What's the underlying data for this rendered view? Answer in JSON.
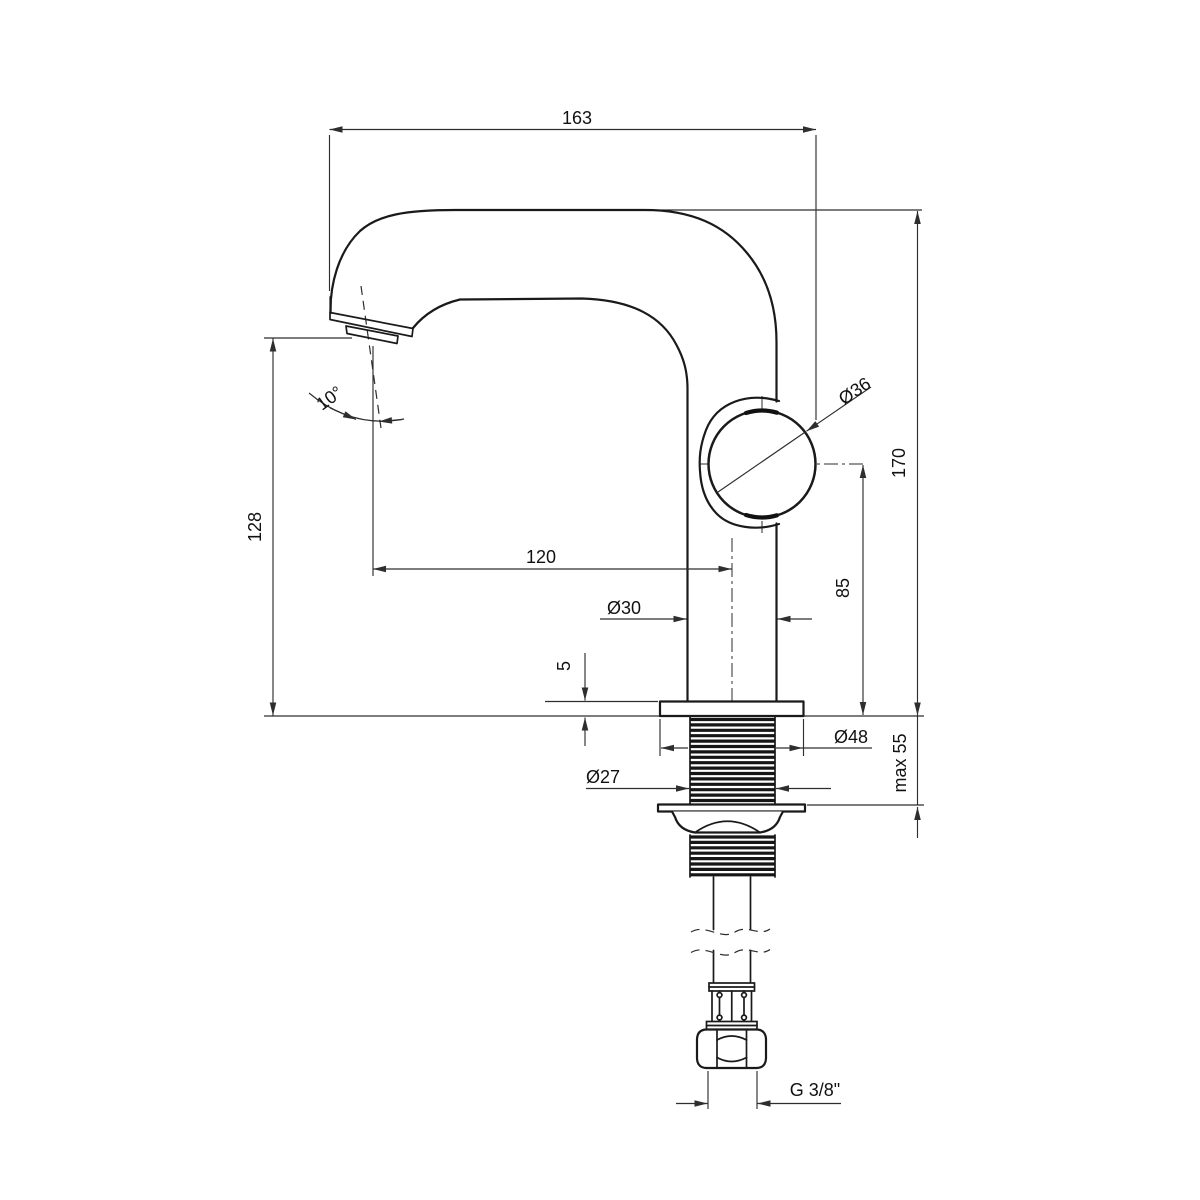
{
  "drawing": {
    "title": "Basin mixer tap – dimensional technical drawing",
    "background_color": "#ffffff",
    "line_color": "#1a1a1a",
    "labels": {
      "spout_reach": "163",
      "overall_height": "170",
      "outlet_height": "128",
      "outlet_to_body_axis": "120",
      "handle_diameter": "Ø36",
      "body_diameter": "Ø30",
      "handle_axis_above_deck": "85",
      "base_plate_thickness": "5",
      "base_plate_diameter": "Ø48",
      "shank_thread_diameter": "Ø27",
      "max_deck_thickness": "max 55",
      "outlet_angle": "10°",
      "supply_connection_thread": "G 3/8\""
    }
  }
}
